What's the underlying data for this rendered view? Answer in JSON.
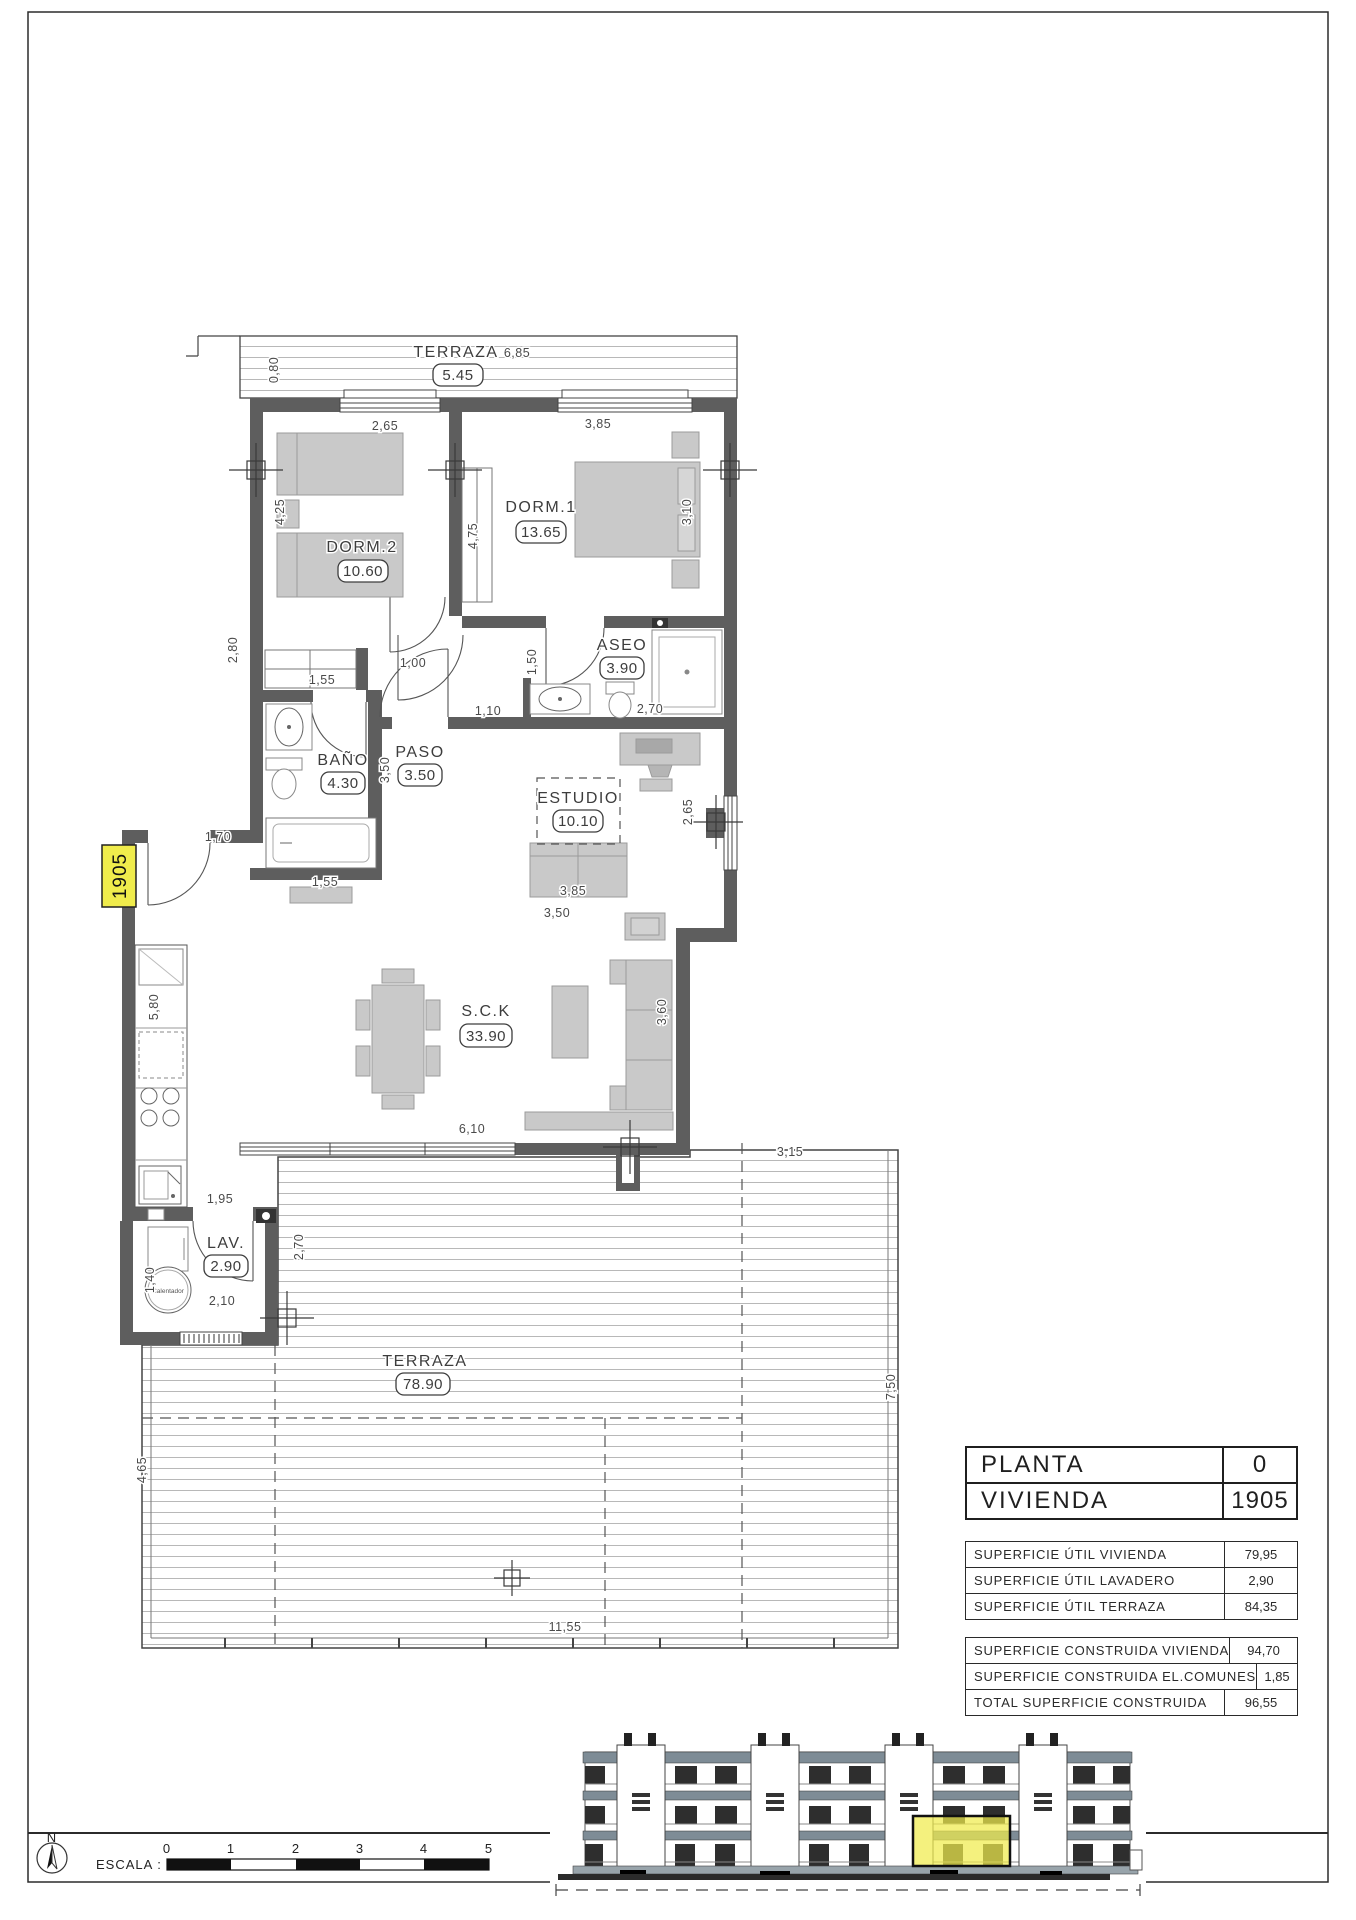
{
  "drawing": {
    "unit_tag": "1905",
    "rooms": {
      "terraza_top": {
        "name": "TERRAZA",
        "area": "5.45"
      },
      "dorm2": {
        "name": "DORM.2",
        "area": "10.60"
      },
      "dorm1": {
        "name": "DORM.1",
        "area": "13.65"
      },
      "aseo": {
        "name": "ASEO",
        "area": "3.90"
      },
      "bano": {
        "name": "BAÑO",
        "area": "4.30"
      },
      "paso": {
        "name": "PASO",
        "area": "3.50"
      },
      "estudio": {
        "name": "ESTUDIO",
        "area": "10.10"
      },
      "sck": {
        "name": "S.C.K",
        "area": "33.90"
      },
      "lav": {
        "name": "LAV.",
        "area": "2.90"
      },
      "terraza_main": {
        "name": "TERRAZA",
        "area": "78.90"
      }
    },
    "dims": {
      "terraza_top_width": "6,85",
      "terraza_top_depth": "0,80",
      "dorm2_width": "2,65",
      "dorm2_depth": "4,25",
      "dorm1_width": "3,85",
      "dorm1_depth_left": "4,75",
      "dorm1_depth_right": "3,10",
      "aseo_depth": "1,50",
      "aseo_width": "2,70",
      "paso_opening": "1,00",
      "paso_opening2": "1,10",
      "paso_depth": "3,50",
      "bano_depth": "2,80",
      "wardrobe_width": "1,55",
      "bath_width": "1,55",
      "estudio_width": "3,85",
      "estudio_depth": "2,65",
      "sofa_width": "3,50",
      "entry_width": "1,70",
      "kitchen_depth": "5,80",
      "sck_width": "6,10",
      "sck_depth": "3,60",
      "kitchen_width": "1,95",
      "lav_depth": "2,70",
      "lav_width": "2,10",
      "lav_side": "1,40",
      "terraza_right_width": "3,15",
      "terraza_right_depth": "7,50",
      "terraza_width": "11,55",
      "terraza_left_depth": "4,65"
    },
    "annotations": {
      "calentador": "Calentador"
    }
  },
  "title_block": {
    "rows": [
      {
        "label": "PLANTA",
        "value": "0"
      },
      {
        "label": "VIVIENDA",
        "value": "1905"
      }
    ]
  },
  "surface_tables": {
    "util": {
      "rows": [
        {
          "label": "SUPERFICIE ÚTIL VIVIENDA",
          "value": "79,95"
        },
        {
          "label": "SUPERFICIE ÚTIL LAVADERO",
          "value": "2,90"
        },
        {
          "label": "SUPERFICIE ÚTIL TERRAZA",
          "value": "84,35"
        }
      ]
    },
    "construida": {
      "rows": [
        {
          "label": "SUPERFICIE CONSTRUIDA VIVIENDA",
          "value": "94,70"
        },
        {
          "label": "SUPERFICIE CONSTRUIDA EL.COMUNES",
          "value": "1,85"
        },
        {
          "label": "TOTAL SUPERFICIE CONSTRUIDA",
          "value": "96,55"
        }
      ]
    }
  },
  "footer": {
    "north_label": "N",
    "scale_label": "ESCALA :",
    "scale_ticks": [
      "0",
      "1",
      "2",
      "3",
      "4",
      "5"
    ]
  },
  "colors": {
    "wall": "#5e5e5e",
    "furniture": "#c9c9c9",
    "highlight": "#f0ec4c",
    "stripe": "#b8b8b8"
  }
}
